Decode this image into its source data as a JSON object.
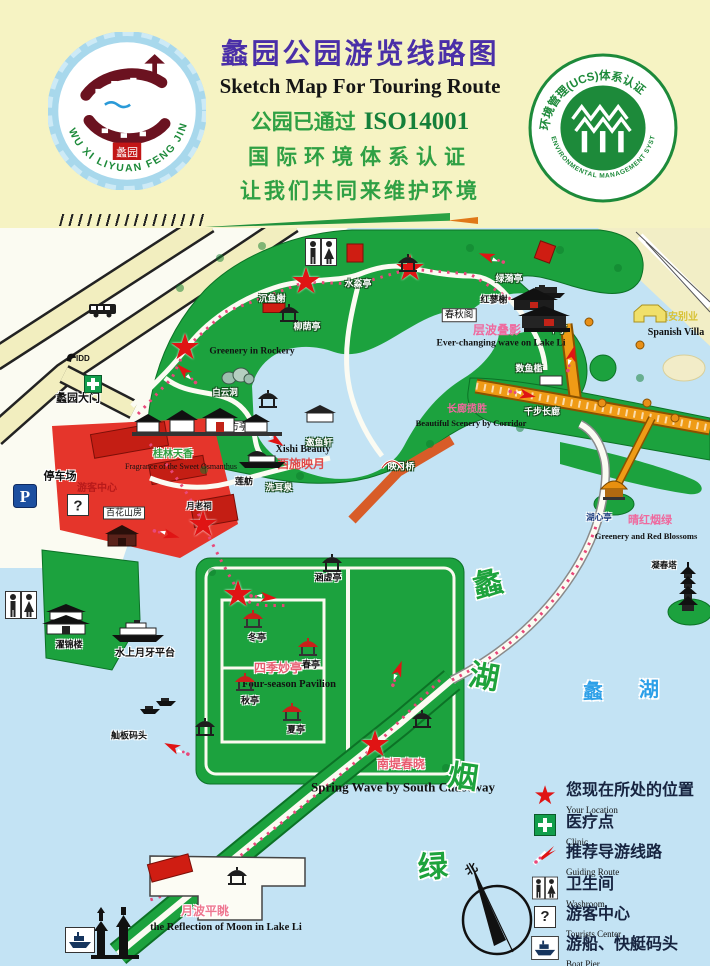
{
  "header": {
    "title_cn": "蠡园公园游览线路图",
    "title_en": "Sketch Map For Touring Route",
    "cert_prefix": "公园已通过",
    "cert_code": "ISO14001",
    "cert_line2": "国际环境体系认证",
    "cert_line3": "让我们共同来维护环境",
    "left_badge": {
      "ring_text": "WU XI LIYUAN FENG JING QU",
      "seal": "蠡园"
    },
    "right_badge": {
      "top_text": "环境管理(UCS)体系认证",
      "bottom_text": "ENVIRONMENTAL MANAGEMENT SYSTEMS CERTIFICATION"
    }
  },
  "map": {
    "compass_north": "北",
    "colors": {
      "water": "#c3e3f4",
      "land": "#1ca23e",
      "road": "#f2eebf",
      "plaza": "#e5352b",
      "corridor": "#ef9b16",
      "star": "#e01414",
      "scenic_pink": "#ef6a9e",
      "big_green": "#1ea33c",
      "lake_blue": "#2da0e8"
    },
    "labels": [
      {
        "t": "蠡园大门",
        "x": 78,
        "y": 171,
        "s": 11,
        "c": "#111",
        "b": 1,
        "h": "w"
      },
      {
        "t": "停车场",
        "x": 60,
        "y": 249,
        "s": 11,
        "c": "#111",
        "b": 1,
        "h": "w"
      },
      {
        "t": "游客中心",
        "x": 97,
        "y": 261,
        "s": 10,
        "c": "#b81a1a",
        "b": 1
      },
      {
        "t": "百花山房",
        "x": 124,
        "y": 285,
        "s": 9,
        "c": "#111",
        "box": 1
      },
      {
        "t": "Greenery in Rockery",
        "x": 252,
        "y": 124,
        "s": 9.5,
        "c": "#111",
        "f": 1,
        "b": 1
      },
      {
        "t": "沉鱼榭",
        "x": 272,
        "y": 71,
        "s": 9,
        "c": "#fff",
        "b": 1,
        "h": "d"
      },
      {
        "t": "水淼亭",
        "x": 358,
        "y": 56,
        "s": 9,
        "c": "#fff",
        "b": 1,
        "h": "d"
      },
      {
        "t": "柳荫亭",
        "x": 307,
        "y": 99,
        "s": 9,
        "c": "#fff",
        "b": 1,
        "h": "d"
      },
      {
        "t": "Xishi Beauty",
        "x": 303,
        "y": 222,
        "s": 10,
        "c": "#111",
        "f": 1,
        "b": 1
      },
      {
        "t": "西施映月",
        "x": 301,
        "y": 236,
        "s": 12,
        "c": "#e04b4b",
        "b": 1
      },
      {
        "t": "映月桥",
        "x": 401,
        "y": 239,
        "s": 9,
        "c": "#fff",
        "b": 1,
        "h": "d"
      },
      {
        "t": "春秋阁",
        "x": 459,
        "y": 87,
        "s": 9.5,
        "c": "#111",
        "box": 1
      },
      {
        "t": "红蓼榭",
        "x": 494,
        "y": 72,
        "s": 9,
        "c": "#111",
        "b": 1,
        "h": "w"
      },
      {
        "t": "绿漪亭",
        "x": 509,
        "y": 51,
        "s": 9,
        "c": "#fff",
        "b": 1,
        "h": "d"
      },
      {
        "t": "层波叠影",
        "x": 497,
        "y": 102,
        "s": 12,
        "c": "#ef6a9e",
        "b": 1
      },
      {
        "t": "Ever-changing wave on Lake Li",
        "x": 501,
        "y": 116,
        "s": 9.5,
        "c": "#111",
        "f": 1,
        "b": 1
      },
      {
        "t": "半亭",
        "x": 558,
        "y": 102,
        "s": 9,
        "c": "#fff",
        "b": 1,
        "h": "d"
      },
      {
        "t": "颐安别业",
        "x": 678,
        "y": 90,
        "s": 10,
        "c": "#d8c235",
        "b": 1
      },
      {
        "t": "Spanish Villa",
        "x": 676,
        "y": 105,
        "s": 10,
        "c": "#111",
        "f": 1,
        "b": 1
      },
      {
        "t": "数鱼槛",
        "x": 529,
        "y": 141,
        "s": 9,
        "c": "#fff",
        "b": 1,
        "h": "d"
      },
      {
        "t": "千步长廊",
        "x": 542,
        "y": 184,
        "s": 9,
        "c": "#fff",
        "b": 1,
        "h": "d"
      },
      {
        "t": "长廊揽胜",
        "x": 467,
        "y": 182,
        "s": 10,
        "c": "#ef6a9e",
        "b": 1
      },
      {
        "t": "Beautiful Scenery by Corridor",
        "x": 471,
        "y": 195,
        "s": 8.5,
        "c": "#111",
        "f": 1,
        "b": 1
      },
      {
        "t": "白云洞",
        "x": 225,
        "y": 164,
        "s": 8.5,
        "c": "#fff",
        "b": 1,
        "h": "d"
      },
      {
        "t": "方亭",
        "x": 239,
        "y": 199,
        "s": 9,
        "c": "#111",
        "box": 1
      },
      {
        "t": "邀鱼轩",
        "x": 319,
        "y": 215,
        "s": 9,
        "c": "#fff",
        "b": 1,
        "h": "d"
      },
      {
        "t": "莲舫",
        "x": 244,
        "y": 254,
        "s": 9,
        "c": "#111",
        "b": 1,
        "h": "w"
      },
      {
        "t": "洗耳泉",
        "x": 279,
        "y": 260,
        "s": 9,
        "c": "#fff",
        "b": 1,
        "h": "d"
      },
      {
        "t": "桂林天香",
        "x": 173,
        "y": 227,
        "s": 10,
        "c": "#2f9e3f",
        "b": 1,
        "h": "w"
      },
      {
        "t": "Fragrance of the Sweet Osmanthus",
        "x": 181,
        "y": 239,
        "s": 8,
        "c": "#111",
        "f": 1
      },
      {
        "t": "月老祠",
        "x": 199,
        "y": 278,
        "s": 8.5,
        "c": "#111",
        "b": 1,
        "h": "w"
      },
      {
        "t": "涵虚亭",
        "x": 328,
        "y": 350,
        "s": 9,
        "c": "#111",
        "b": 1,
        "h": "w"
      },
      {
        "t": "冬亭",
        "x": 257,
        "y": 410,
        "s": 9,
        "c": "#111",
        "b": 1,
        "h": "w"
      },
      {
        "t": "春亭",
        "x": 311,
        "y": 437,
        "s": 9,
        "c": "#111",
        "b": 1,
        "h": "w"
      },
      {
        "t": "四季妙亭",
        "x": 278,
        "y": 440,
        "s": 12,
        "c": "#e85c70",
        "b": 1,
        "h": "w"
      },
      {
        "t": "Four-season Pavilion",
        "x": 289,
        "y": 457,
        "s": 10.5,
        "c": "#111",
        "f": 1,
        "b": 1
      },
      {
        "t": "秋亭",
        "x": 250,
        "y": 473,
        "s": 9,
        "c": "#111",
        "b": 1,
        "h": "w"
      },
      {
        "t": "夏亭",
        "x": 296,
        "y": 502,
        "s": 9,
        "c": "#111",
        "b": 1,
        "h": "w"
      },
      {
        "t": "濯锦楼",
        "x": 69,
        "y": 417,
        "s": 9,
        "c": "#111",
        "b": 1,
        "h": "w"
      },
      {
        "t": "水上月牙平台",
        "x": 145,
        "y": 426,
        "s": 10,
        "c": "#111",
        "b": 1,
        "h": "w"
      },
      {
        "t": "舢板码头",
        "x": 129,
        "y": 508,
        "s": 9,
        "c": "#111",
        "b": 1,
        "h": "w"
      },
      {
        "t": "南堤春晓",
        "x": 401,
        "y": 536,
        "s": 12,
        "c": "#e85c70",
        "b": 1,
        "h": "w"
      },
      {
        "t": "Spring Wave by South Causeway",
        "x": 403,
        "y": 559,
        "s": 13,
        "c": "#111",
        "f": 1,
        "b": 1
      },
      {
        "t": "月波平眺",
        "x": 205,
        "y": 683,
        "s": 12,
        "c": "#ee7890",
        "b": 1,
        "h": "w"
      },
      {
        "t": "the Reflection of Moon in Lake Li",
        "x": 226,
        "y": 700,
        "s": 10.5,
        "c": "#111",
        "f": 1,
        "b": 1
      },
      {
        "t": "湖心亭",
        "x": 599,
        "y": 289,
        "s": 8.5,
        "c": "#1a3a7c",
        "b": 1,
        "h": "w"
      },
      {
        "t": "晴红烟绿",
        "x": 650,
        "y": 293,
        "s": 11,
        "c": "#ef6a9e",
        "b": 1
      },
      {
        "t": "Greenery and Red Blossoms",
        "x": 646,
        "y": 308,
        "s": 8.5,
        "c": "#111",
        "f": 1,
        "b": 1
      },
      {
        "t": "凝春塔",
        "x": 664,
        "y": 337,
        "s": 8.5,
        "c": "#111",
        "b": 1,
        "h": "w"
      }
    ],
    "big_chars": [
      {
        "t": "蠡",
        "x": 488,
        "y": 357,
        "s": 30,
        "c": "#1ea33c",
        "rot": -14
      },
      {
        "t": "湖",
        "x": 484,
        "y": 450,
        "s": 30,
        "c": "#1ea33c",
        "rot": 10
      },
      {
        "t": "烟",
        "x": 463,
        "y": 550,
        "s": 30,
        "c": "#1ea33c",
        "rot": 8
      },
      {
        "t": "绿",
        "x": 433,
        "y": 640,
        "s": 30,
        "c": "#1ea33c",
        "rot": -4
      },
      {
        "t": "蠡",
        "x": 593,
        "y": 464,
        "s": 20,
        "c": "#2da0e8",
        "rot": 0
      },
      {
        "t": "湖",
        "x": 649,
        "y": 462,
        "s": 20,
        "c": "#2da0e8",
        "rot": 0
      }
    ],
    "stars": [
      [
        185,
        119
      ],
      [
        306,
        53
      ],
      [
        410,
        40
      ],
      [
        203,
        296
      ],
      [
        238,
        366
      ],
      [
        375,
        516
      ]
    ],
    "arrows": [
      [
        492,
        30,
        200
      ],
      [
        522,
        166,
        12
      ],
      [
        571,
        131,
        -75
      ],
      [
        272,
        210,
        35
      ],
      [
        263,
        369,
        5
      ],
      [
        397,
        446,
        -70
      ],
      [
        177,
        521,
        205
      ],
      [
        187,
        146,
        225
      ],
      [
        166,
        306,
        15
      ]
    ],
    "icons": [
      {
        "t": "bus",
        "x": 103,
        "y": 82
      },
      {
        "t": "idd",
        "x": 80,
        "y": 129
      },
      {
        "t": "clinic",
        "x": 93,
        "y": 156
      },
      {
        "t": "parking",
        "x": 25,
        "y": 268
      },
      {
        "t": "question",
        "x": 78,
        "y": 277
      },
      {
        "t": "washroom",
        "x": 321,
        "y": 24
      },
      {
        "t": "washroom",
        "x": 21,
        "y": 377
      },
      {
        "t": "redrect",
        "x": 355,
        "y": 25
      },
      {
        "t": "redrect",
        "x": 545,
        "y": 24,
        "r": 20
      },
      {
        "t": "redrect",
        "x": 274,
        "y": 80,
        "w": 24,
        "h": 11
      },
      {
        "t": "barge",
        "x": 547,
        "y": 64
      },
      {
        "t": "pavilion",
        "x": 408,
        "y": 36
      },
      {
        "t": "pavilion",
        "x": 289,
        "y": 86
      },
      {
        "t": "pavilion",
        "x": 268,
        "y": 172
      },
      {
        "t": "building",
        "x": 320,
        "y": 186
      },
      {
        "t": "boatbldg",
        "x": 262,
        "y": 231
      },
      {
        "t": "rock",
        "x": 238,
        "y": 148
      },
      {
        "t": "bigbldg",
        "x": 540,
        "y": 80
      },
      {
        "t": "hall",
        "x": 122,
        "y": 308
      },
      {
        "t": "gate",
        "x": 210,
        "y": 198
      },
      {
        "t": "bldg2",
        "x": 66,
        "y": 392
      },
      {
        "t": "ship",
        "x": 138,
        "y": 404
      },
      {
        "t": "boat",
        "x": 150,
        "y": 482
      },
      {
        "t": "boat",
        "x": 166,
        "y": 474
      },
      {
        "t": "pavilion",
        "x": 205,
        "y": 500
      },
      {
        "t": "pavilion",
        "x": 422,
        "y": 492
      },
      {
        "t": "pavred",
        "x": 253,
        "y": 392
      },
      {
        "t": "pavred",
        "x": 308,
        "y": 420
      },
      {
        "t": "pavred",
        "x": 245,
        "y": 455
      },
      {
        "t": "pavred",
        "x": 292,
        "y": 485
      },
      {
        "t": "pavilion",
        "x": 332,
        "y": 336
      },
      {
        "t": "pavorange",
        "x": 614,
        "y": 262
      },
      {
        "t": "pagoda",
        "x": 688,
        "y": 360
      },
      {
        "t": "villa",
        "x": 650,
        "y": 87
      },
      {
        "t": "islet",
        "x": 684,
        "y": 140
      },
      {
        "t": "towers",
        "x": 115,
        "y": 702
      },
      {
        "t": "boatbox",
        "x": 80,
        "y": 712
      },
      {
        "t": "pavilion",
        "x": 237,
        "y": 649
      },
      {
        "t": "redrect",
        "x": 170,
        "y": 640,
        "r": -15,
        "w": 44,
        "h": 20
      },
      {
        "t": "moonbridge",
        "x": 392,
        "y": 236
      },
      {
        "t": "dot",
        "x": 589,
        "y": 94
      },
      {
        "t": "dot",
        "x": 640,
        "y": 117
      },
      {
        "t": "dot",
        "x": 602,
        "y": 175
      },
      {
        "t": "dot",
        "x": 647,
        "y": 175
      },
      {
        "t": "dot",
        "x": 675,
        "y": 190
      }
    ]
  },
  "legend": {
    "items": [
      {
        "cn": "您现在所处的位置",
        "en": "Your Location"
      },
      {
        "cn": "医疗点",
        "en": "Clinic"
      },
      {
        "cn": "推荐导游线路",
        "en": "Guiding Route"
      },
      {
        "cn": "卫生间",
        "en": "Washroom"
      },
      {
        "cn": "游客中心",
        "en": "Tourists Center"
      },
      {
        "cn": "游船、快艇码头",
        "en": "Boat Pier"
      }
    ]
  }
}
